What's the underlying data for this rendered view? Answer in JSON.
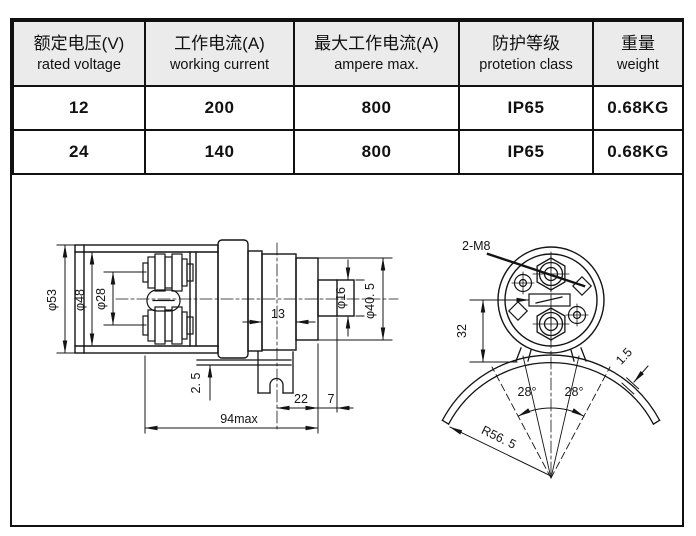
{
  "colors": {
    "line": "#141414",
    "header_bg": "#ebebeb",
    "text": "#111111",
    "background": "#ffffff"
  },
  "table": {
    "columns": [
      {
        "zh": "额定电压(V)",
        "en": "rated voltage"
      },
      {
        "zh": "工作电流(A)",
        "en": "working current"
      },
      {
        "zh": "最大工作电流(A)",
        "en": "ampere max."
      },
      {
        "zh": "防护等级",
        "en": "protetion class"
      },
      {
        "zh": "重量",
        "en": "weight"
      }
    ],
    "rows": [
      [
        "12",
        "200",
        "800",
        "IP65",
        "0.68KG"
      ],
      [
        "24",
        "140",
        "800",
        "IP65",
        "0.68KG"
      ]
    ]
  },
  "side_view": {
    "label_phi53": "φ53",
    "label_phi48": "φ48",
    "label_phi28": "φ28",
    "label_13": "13",
    "label_phi16": "φ16",
    "label_phi40_5": "φ40. 5",
    "label_2_5": "2. 5",
    "label_22": "22",
    "label_7": "7",
    "label_94max": "94max"
  },
  "front_view": {
    "label_2m8": "2-M8",
    "label_32": "32",
    "label_28_left": "28°",
    "label_28_right": "28°",
    "label_1_5": "1.5",
    "label_r56_5": "R56. 5"
  }
}
